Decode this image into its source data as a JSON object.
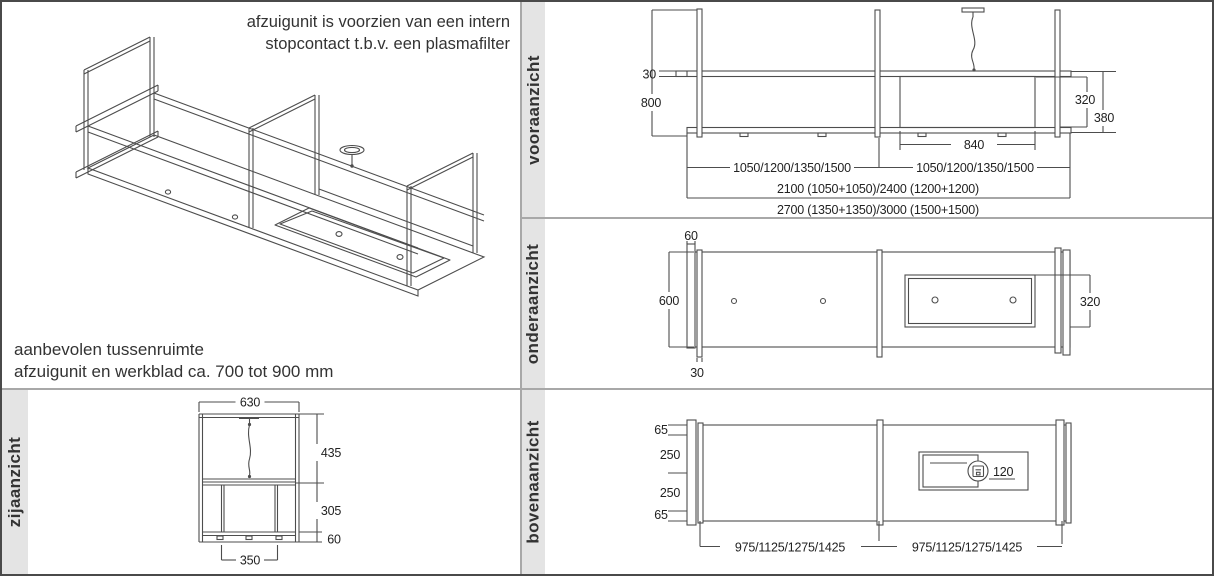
{
  "colors": {
    "line": "#4d4d4d",
    "strip_bg": "#e4e4e4",
    "divider": "#a8a8a8",
    "text": "#2d2d2d"
  },
  "isometric": {
    "note_line1": "afzuigunit is voorzien van een intern",
    "note_line2": "stopcontact t.b.v. een plasmafilter",
    "hint_line1": "aanbevolen tussenruimte",
    "hint_line2": "afzuigunit en werkblad ca. 700 tot 900 mm"
  },
  "front_view": {
    "label": "vooraanzicht",
    "dims": {
      "d30": "30",
      "d800": "800",
      "d320": "320",
      "d380": "380",
      "d840": "840",
      "row_left": "1050/1200/1350/1500",
      "row_right": "1050/1200/1350/1500",
      "row_total_a": "2100 (1050+1050)/2400 (1200+1200)",
      "row_total_b": "2700 (1350+1350)/3000 (1500+1500)"
    }
  },
  "bottom_view": {
    "label": "onderaanzicht",
    "dims": {
      "d60": "60",
      "d600": "600",
      "d30": "30",
      "d320": "320"
    }
  },
  "top_view": {
    "label": "bovenaanzicht",
    "dims": {
      "d65_top": "65",
      "d250_top": "250",
      "d250_bottom": "250",
      "d65_bottom": "65",
      "d120": "120",
      "row_left": "975/1125/1275/1425",
      "row_right": "975/1125/1275/1425"
    }
  },
  "side_view": {
    "label": "zijaanzicht",
    "dims": {
      "d630": "630",
      "d435": "435",
      "d305": "305",
      "d60": "60",
      "d350": "350"
    }
  }
}
